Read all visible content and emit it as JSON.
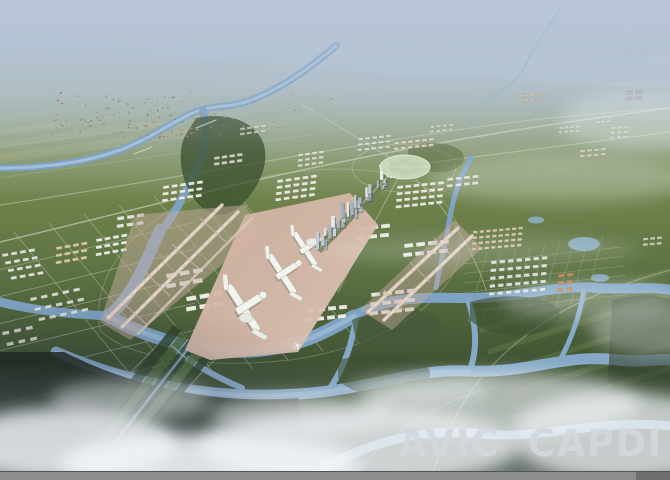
{
  "watermark": {
    "text": "AVIC  CAPDI",
    "color": "#d2d8de",
    "opacity": 0.9
  },
  "icons": {
    "airplane_glyph": "✈"
  },
  "chrome": {
    "bottom_bar_color": "#8d8d8d",
    "bottom_bar_edge_color": "#545454",
    "bottom_bar_right_segment_color": "#6f6f6f"
  },
  "scene": {
    "palette": {
      "sky_haze": "#b6c4d6",
      "mountains_far": "#8ba0b6",
      "mountains_near": "#7d9178",
      "fields": "#77894f",
      "forest_dark": "#1e2a1c",
      "river": "#7ea2c2",
      "river_light": "#a8c3da",
      "apron_pink": "#cfae9f",
      "buildings_white": "#f0f1ea",
      "fog_white": "#f2f6f9"
    },
    "clusters": [
      {
        "x": 163,
        "y": 186,
        "cols": 5,
        "rows": 3,
        "w": 6,
        "h": 3,
        "gx": 2.5,
        "gy": 3.5,
        "sx": -1.5,
        "rot": -8,
        "color": "#edeee5",
        "op": 0.95
      },
      {
        "x": 277,
        "y": 180,
        "cols": 5,
        "rows": 4,
        "w": 6,
        "h": 3,
        "gx": 2.5,
        "gy": 3,
        "sx": -1.5,
        "rot": -8,
        "color": "#edeee5",
        "op": 0.92
      },
      {
        "x": 298,
        "y": 154,
        "cols": 4,
        "rows": 3,
        "w": 5,
        "h": 2.6,
        "gx": 2,
        "gy": 2.6,
        "sx": -1,
        "rot": -8,
        "color": "#e4e6db",
        "op": 0.85
      },
      {
        "x": 358,
        "y": 138,
        "cols": 5,
        "rows": 3,
        "w": 5,
        "h": 2.5,
        "gx": 2,
        "gy": 2.8,
        "sx": -1,
        "rot": -6,
        "color": "#e4e6db",
        "op": 0.8
      },
      {
        "x": 394,
        "y": 142,
        "cols": 6,
        "rows": 2,
        "w": 5,
        "h": 2.6,
        "gx": 2,
        "gy": 3,
        "sx": -1,
        "rot": -6,
        "color": "#e8dfc2",
        "op": 0.85
      },
      {
        "x": 397,
        "y": 186,
        "cols": 6,
        "rows": 4,
        "w": 6,
        "h": 3,
        "gx": 2.2,
        "gy": 3.4,
        "sx": -1.2,
        "rot": -6,
        "color": "#edeee5",
        "op": 0.92
      },
      {
        "x": 473,
        "y": 231,
        "cols": 8,
        "rows": 4,
        "w": 4.5,
        "h": 2.6,
        "gx": 2,
        "gy": 3,
        "sx": -1,
        "rot": -5,
        "color": "#d9c9a2",
        "op": 0.95
      },
      {
        "x": 491,
        "y": 261,
        "cols": 7,
        "rows": 5,
        "w": 5.5,
        "h": 3.2,
        "gx": 3,
        "gy": 4.6,
        "sx": -1.2,
        "rot": -5,
        "color": "#e9eae2",
        "op": 0.9
      },
      {
        "x": 558,
        "y": 274,
        "cols": 2,
        "rows": 3,
        "w": 6,
        "h": 3.6,
        "gx": 3,
        "gy": 3.6,
        "sx": -1,
        "rot": -5,
        "color": "#b9874e",
        "op": 0.95
      },
      {
        "x": 518,
        "y": 95,
        "cols": 4,
        "rows": 2,
        "w": 4.5,
        "h": 2.2,
        "gx": 1.8,
        "gy": 2.4,
        "sx": -0.8,
        "rot": -4,
        "color": "#dcc89e",
        "op": 0.8
      },
      {
        "x": 559,
        "y": 127,
        "cols": 4,
        "rows": 2,
        "w": 4,
        "h": 2,
        "gx": 1.6,
        "gy": 2.2,
        "sx": -0.8,
        "rot": -4,
        "color": "#e2e4da",
        "op": 0.7
      },
      {
        "x": 596,
        "y": 117,
        "cols": 3,
        "rows": 2,
        "w": 4,
        "h": 2,
        "gx": 1.6,
        "gy": 2.2,
        "sx": -0.8,
        "rot": -4,
        "color": "#e2e4da",
        "op": 0.65
      },
      {
        "x": 626,
        "y": 91,
        "cols": 2,
        "rows": 2,
        "w": 7,
        "h": 3.6,
        "gx": 2.2,
        "gy": 2.6,
        "sx": -1,
        "rot": -4,
        "color": "#a595b2",
        "op": 0.75
      },
      {
        "x": 2,
        "y": 254,
        "cols": 4,
        "rows": 4,
        "w": 6,
        "h": 3,
        "gx": 3,
        "gy": 5,
        "sx": 1.5,
        "rot": -10,
        "color": "#e9eae2",
        "op": 0.9
      },
      {
        "x": 56,
        "y": 247,
        "cols": 4,
        "rows": 3,
        "w": 6,
        "h": 3,
        "gx": 2.5,
        "gy": 4,
        "sx": -1.5,
        "rot": -10,
        "color": "#d9c9a2",
        "op": 0.95
      },
      {
        "x": 96,
        "y": 239,
        "cols": 4,
        "rows": 3,
        "w": 6,
        "h": 3,
        "gx": 2.5,
        "gy": 4,
        "sx": -1.5,
        "rot": -10,
        "color": "#edeee5",
        "op": 0.95
      },
      {
        "x": 30,
        "y": 298,
        "cols": 5,
        "rows": 3,
        "w": 6.5,
        "h": 3.2,
        "gx": 4.5,
        "gy": 7.5,
        "sx": 2,
        "rot": -12,
        "color": "#e9eae2",
        "op": 0.85
      },
      {
        "x": 2,
        "y": 332,
        "cols": 3,
        "rows": 2,
        "w": 7,
        "h": 3.5,
        "gx": 5,
        "gy": 8,
        "sx": 2,
        "rot": -12,
        "color": "#e9eae2",
        "op": 0.8
      },
      {
        "x": 166,
        "y": 274,
        "cols": 3,
        "rows": 2,
        "w": 10,
        "h": 4.5,
        "gx": 3.5,
        "gy": 5.5,
        "sx": -2,
        "rot": -10,
        "color": "#f0f1ea",
        "op": 0.97
      },
      {
        "x": 186,
        "y": 297,
        "cols": 3,
        "rows": 2,
        "w": 10,
        "h": 4.5,
        "gx": 3.5,
        "gy": 5.5,
        "sx": -2,
        "rot": -10,
        "color": "#f0f1ea",
        "op": 0.97
      },
      {
        "x": 117,
        "y": 217,
        "cols": 3,
        "rows": 2,
        "w": 7,
        "h": 3.5,
        "gx": 3,
        "gy": 4,
        "sx": -1.5,
        "rot": -8,
        "color": "#edeee5",
        "op": 0.9
      },
      {
        "x": 357,
        "y": 227,
        "cols": 3,
        "rows": 2,
        "w": 9,
        "h": 4,
        "gx": 3,
        "gy": 5,
        "sx": -2,
        "rot": -6,
        "color": "#f0f1ea",
        "op": 0.95
      },
      {
        "x": 404,
        "y": 244,
        "cols": 4,
        "rows": 2,
        "w": 9,
        "h": 4,
        "gx": 3,
        "gy": 5,
        "sx": -2,
        "rot": -6,
        "color": "#f0f1ea",
        "op": 0.95
      },
      {
        "x": 371,
        "y": 293,
        "cols": 4,
        "rows": 3,
        "w": 9,
        "h": 4,
        "gx": 3,
        "gy": 5.2,
        "sx": -2,
        "rot": -6,
        "color": "#f0f1ea",
        "op": 0.95
      },
      {
        "x": 306,
        "y": 309,
        "cols": 4,
        "rows": 2,
        "w": 8,
        "h": 4,
        "gx": 3,
        "gy": 5,
        "sx": -2,
        "rot": -6,
        "color": "#f0f1ea",
        "op": 0.95
      },
      {
        "x": 447,
        "y": 178,
        "cols": 4,
        "rows": 2,
        "w": 6,
        "h": 3,
        "gx": 2.5,
        "gy": 3.5,
        "sx": -1,
        "rot": -6,
        "color": "#e9eae2",
        "op": 0.85
      },
      {
        "x": 580,
        "y": 150,
        "cols": 4,
        "rows": 2,
        "w": 5,
        "h": 2.4,
        "gx": 2,
        "gy": 2.6,
        "sx": -0.8,
        "rot": -5,
        "color": "#e8dfc2",
        "op": 0.7
      },
      {
        "x": 611,
        "y": 127,
        "cols": 3,
        "rows": 3,
        "w": 4.5,
        "h": 2.2,
        "gx": 2,
        "gy": 2.6,
        "sx": -0.8,
        "rot": -4,
        "color": "#e2e4da",
        "op": 0.6
      },
      {
        "x": 643,
        "y": 238,
        "cols": 3,
        "rows": 2,
        "w": 5,
        "h": 2.5,
        "gx": 2,
        "gy": 3,
        "sx": -0.8,
        "rot": -5,
        "color": "#e9eae2",
        "op": 0.7
      },
      {
        "x": 214,
        "y": 157,
        "cols": 4,
        "rows": 2,
        "w": 5.5,
        "h": 2.8,
        "gx": 2.2,
        "gy": 3,
        "sx": -1,
        "rot": -8,
        "color": "#e9eae2",
        "op": 0.8
      },
      {
        "x": 240,
        "y": 128,
        "cols": 4,
        "rows": 2,
        "w": 5,
        "h": 2.4,
        "gx": 2,
        "gy": 2.6,
        "sx": -1,
        "rot": -8,
        "color": "#dfe1d5",
        "op": 0.7
      },
      {
        "x": 430,
        "y": 126,
        "cols": 4,
        "rows": 2,
        "w": 4.5,
        "h": 2.2,
        "gx": 1.8,
        "gy": 2.4,
        "sx": -0.8,
        "rot": -6,
        "color": "#e2e4da",
        "op": 0.7
      }
    ],
    "dotfields": [
      {
        "name": "village-roofs",
        "x": 52,
        "y": 92,
        "w": 150,
        "h": 46,
        "n": 140,
        "seed": 7,
        "rmin": 0.8,
        "rmax": 2.2,
        "colors": [
          "#9b6a4e",
          "#b5503e",
          "#c8b790",
          "#8a7a5e",
          "#6f7d52",
          "#c08a52"
        ],
        "op": 0.9
      },
      {
        "name": "distant-city",
        "x": 340,
        "y": 56,
        "w": 330,
        "h": 96,
        "n": 280,
        "seed": 3,
        "rmin": 0.5,
        "rmax": 1.5,
        "colors": [
          "#c8cec6",
          "#bcc4ba",
          "#d2d6cc",
          "#a9b2a6"
        ],
        "op": 0.5
      },
      {
        "name": "riverside-sprawl",
        "x": 208,
        "y": 94,
        "w": 132,
        "h": 42,
        "n": 90,
        "seed": 11,
        "rmin": 0.6,
        "rmax": 1.7,
        "colors": [
          "#c2bfa8",
          "#a8a890",
          "#8f8f76",
          "#b3552f"
        ],
        "op": 0.6
      },
      {
        "name": "far-city",
        "x": 598,
        "y": 22,
        "w": 72,
        "h": 32,
        "n": 50,
        "seed": 5,
        "rmin": 0.6,
        "rmax": 1.9,
        "colors": [
          "#d5dad8",
          "#c2cac8"
        ],
        "op": 0.55
      }
    ],
    "linesets": [
      {
        "name": "grid-bottom-left-a",
        "x1": -10,
        "y1": 272,
        "x2": 195,
        "y2": 222,
        "n": 6,
        "ox": 0,
        "oy": 27,
        "w": 0.9,
        "color": "#c6cabe",
        "op": 0.5
      },
      {
        "name": "grid-bottom-left-b",
        "x1": 14,
        "y1": 232,
        "x2": 148,
        "y2": 396,
        "n": 7,
        "ox": 35,
        "oy": -9,
        "w": 0.9,
        "color": "#c6cabe",
        "op": 0.45
      },
      {
        "name": "grid-right-a",
        "x1": 462,
        "y1": 264,
        "x2": 622,
        "y2": 247,
        "n": 6,
        "ox": 1,
        "oy": 9.5,
        "w": 0.7,
        "color": "#b8bcb0",
        "op": 0.4
      },
      {
        "name": "grid-right-b",
        "x1": 487,
        "y1": 252,
        "x2": 468,
        "y2": 322,
        "n": 9,
        "ox": 14.5,
        "oy": -2,
        "w": 0.7,
        "color": "#b8bcb0",
        "op": 0.35
      },
      {
        "name": "field-roads",
        "x1": 0,
        "y1": 132,
        "x2": 335,
        "y2": 86,
        "n": 4,
        "ox": -6,
        "oy": 16,
        "w": 0.6,
        "color": "#d8dcd0",
        "op": 0.3
      },
      {
        "name": "field-strips-tan",
        "x1": 0,
        "y1": 120,
        "x2": 330,
        "y2": 76,
        "n": 4,
        "ox": -4,
        "oy": 13,
        "w": 7,
        "color": "#b2ac7c",
        "op": 0.28
      },
      {
        "name": "field-strips-green",
        "x1": 0,
        "y1": 113,
        "x2": 330,
        "y2": 70,
        "n": 4,
        "ox": -5,
        "oy": 13,
        "w": 4,
        "color": "#7d9154",
        "op": 0.3
      },
      {
        "name": "field-strips-right",
        "x1": 480,
        "y1": 330,
        "x2": 670,
        "y2": 270,
        "n": 5,
        "ox": 8,
        "oy": 22,
        "w": 6,
        "color": "#8e9a62",
        "op": 0.22
      },
      {
        "name": "corridor-roads",
        "x1": 26,
        "y1": 480,
        "x2": 170,
        "y2": 332,
        "n": 3,
        "ox": 30,
        "oy": 6,
        "w": 1,
        "color": "#aab2bc",
        "op": 0.6
      }
    ],
    "axis_towers": {
      "x1": 321,
      "y1": 247,
      "x2": 389,
      "y2": 174,
      "n": 30,
      "seed": 21,
      "hmin": 5,
      "hmax": 17,
      "wmin": 2,
      "wmax": 3.6,
      "colors": [
        "#c3ccd2",
        "#e9edf0",
        "#aab6be",
        "#d6dce0"
      ],
      "shadow": "#3e4a52"
    }
  }
}
